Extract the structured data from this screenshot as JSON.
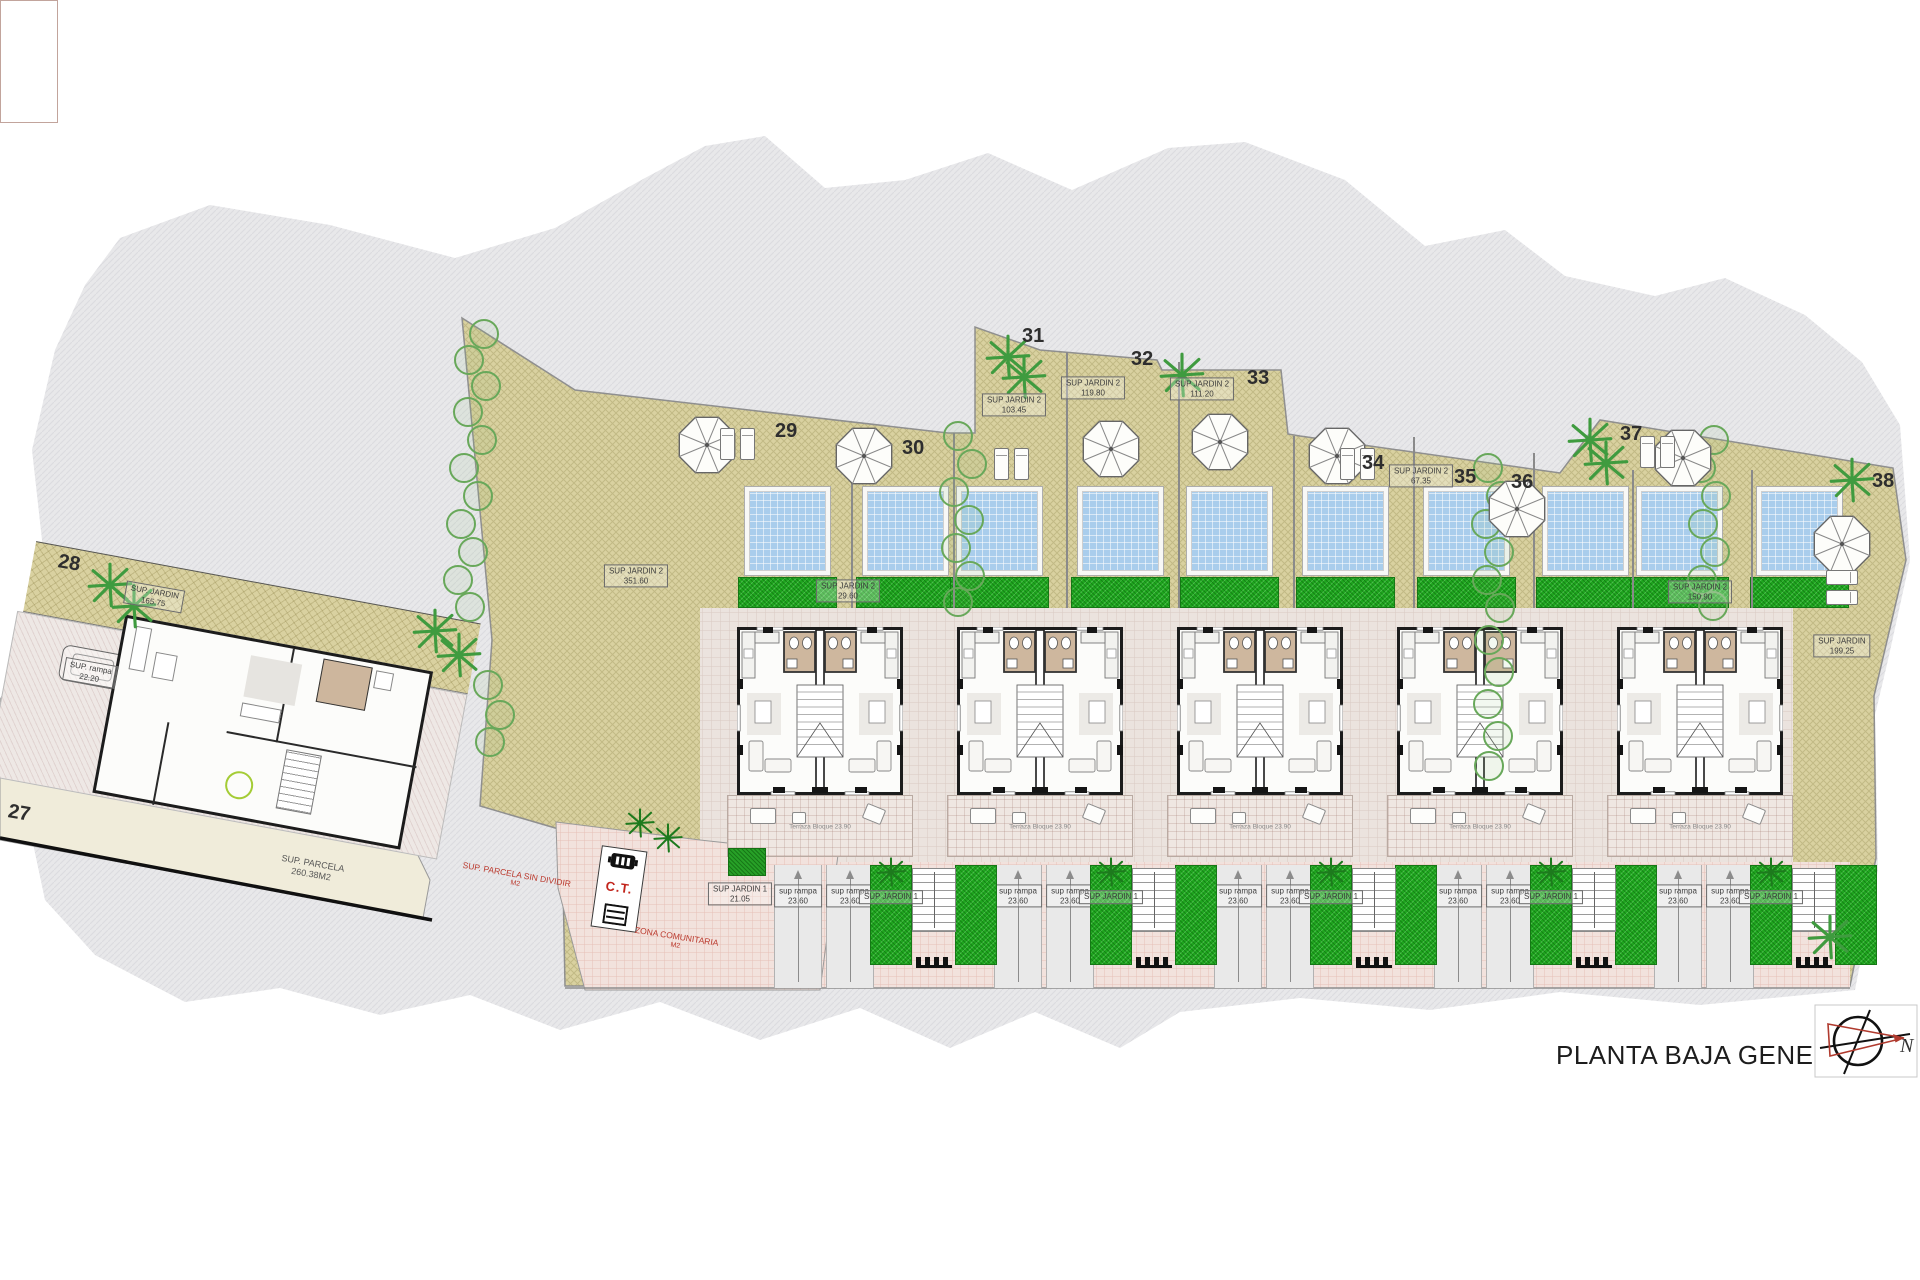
{
  "title": "PLANTA BAJA GENERAL",
  "compass": {
    "north": "N"
  },
  "transformer": {
    "label": "C.T."
  },
  "plot_numbers": [
    {
      "n": "27",
      "x": 8,
      "y": 802,
      "r": 10
    },
    {
      "n": "28",
      "x": 58,
      "y": 552,
      "r": 10
    },
    {
      "n": "29",
      "x": 775,
      "y": 420,
      "r": 0
    },
    {
      "n": "30",
      "x": 902,
      "y": 437,
      "r": 0
    },
    {
      "n": "31",
      "x": 1022,
      "y": 325,
      "r": 0
    },
    {
      "n": "32",
      "x": 1131,
      "y": 348,
      "r": 0
    },
    {
      "n": "33",
      "x": 1247,
      "y": 367,
      "r": 0
    },
    {
      "n": "34",
      "x": 1362,
      "y": 452,
      "r": 0
    },
    {
      "n": "35",
      "x": 1454,
      "y": 466,
      "r": 0
    },
    {
      "n": "36",
      "x": 1511,
      "y": 471,
      "r": 0
    },
    {
      "n": "37",
      "x": 1620,
      "y": 423,
      "r": 0
    },
    {
      "n": "38",
      "x": 1872,
      "y": 470,
      "r": 0
    }
  ],
  "area_labels": [
    {
      "l1": "SUP. JARDIN",
      "l2": "165.75",
      "x": 154,
      "y": 597,
      "r": 10,
      "box": true
    },
    {
      "l1": "SUP. rampa",
      "l2": "22.20",
      "x": 90,
      "y": 673,
      "r": 10,
      "box": true
    },
    {
      "l1": "SUP. PARCELA",
      "l2": "260.38M2",
      "x": 312,
      "y": 869,
      "r": 10,
      "box": false
    },
    {
      "l1": "SUP JARDIN 2",
      "l2": "351.60",
      "x": 636,
      "y": 576,
      "r": 0,
      "box": true
    },
    {
      "l1": "SUP JARDIN 2",
      "l2": "29.60",
      "x": 848,
      "y": 591,
      "r": 0,
      "box": true
    },
    {
      "l1": "SUP JARDIN 2",
      "l2": "103.45",
      "x": 1014,
      "y": 405,
      "r": 0,
      "box": true
    },
    {
      "l1": "SUP JARDIN 2",
      "l2": "119.80",
      "x": 1093,
      "y": 388,
      "r": 0,
      "box": true
    },
    {
      "l1": "SUP JARDIN 2",
      "l2": "111.20",
      "x": 1202,
      "y": 389,
      "r": 0,
      "box": true
    },
    {
      "l1": "SUP JARDIN 2",
      "l2": "67.35",
      "x": 1421,
      "y": 476,
      "r": 0,
      "box": true
    },
    {
      "l1": "SUP JARDIN 2",
      "l2": "150.90",
      "x": 1700,
      "y": 592,
      "r": 0,
      "box": true
    },
    {
      "l1": "SUP JARDIN",
      "l2": "199.25",
      "x": 1842,
      "y": 646,
      "r": 0,
      "box": true
    },
    {
      "l1": "SUP JARDIN 1",
      "l2": "21.05",
      "x": 740,
      "y": 894,
      "r": 0,
      "box": true
    }
  ],
  "hedge_labels": {
    "text": "SUP JARDIN 1",
    "xs": [
      891,
      1111,
      1331,
      1551,
      1771
    ],
    "y": 897
  },
  "ramp_label": {
    "l1": "sup rampa",
    "l2": "23.60"
  },
  "terrace_dim": "Terraza Bloque 23.90",
  "red_notes": [
    {
      "l1": "SUP. PARCELA SIN DIVIDIR",
      "l2": "M2",
      "x": 516,
      "y": 879,
      "r": 10
    },
    {
      "l1": "ZONA COMUNITARIA",
      "l2": "M2",
      "x": 676,
      "y": 941,
      "r": 9
    }
  ],
  "layout": {
    "pools": [
      745,
      863,
      957,
      1078,
      1187,
      1303,
      1424,
      1543,
      1637,
      1757
    ],
    "grass": [
      738,
      856,
      950,
      1071,
      1180,
      1296,
      1417,
      1536,
      1630,
      1750
    ],
    "buildings": [
      737,
      957,
      1177,
      1397,
      1617
    ],
    "ramps": [
      774,
      826,
      994,
      1046,
      1214,
      1266,
      1434,
      1486,
      1654,
      1706
    ],
    "hedges": [
      870,
      955,
      1090,
      1175,
      1310,
      1395,
      1530,
      1615,
      1750,
      1835
    ],
    "stairs": [
      912,
      1132,
      1352,
      1572,
      1792
    ],
    "gates": [
      916,
      1136,
      1356,
      1576,
      1796
    ],
    "patio": [
      710,
      865,
      58,
      123
    ],
    "green_square": [
      728,
      848,
      38,
      28
    ],
    "fences": [
      [
        851,
        433
      ],
      [
        953,
        433
      ],
      [
        1066,
        352
      ],
      [
        1178,
        362
      ],
      [
        1293,
        436
      ],
      [
        1413,
        437
      ],
      [
        1533,
        453
      ],
      [
        1632,
        470
      ],
      [
        1751,
        470
      ]
    ],
    "tree_chains": [
      [
        [
          484,
          334
        ],
        [
          469,
          360
        ],
        [
          486,
          386
        ],
        [
          468,
          412
        ],
        [
          482,
          440
        ],
        [
          464,
          468
        ],
        [
          478,
          496
        ],
        [
          461,
          524
        ],
        [
          473,
          552
        ],
        [
          458,
          580
        ],
        [
          470,
          607
        ],
        [
          488,
          685
        ],
        [
          500,
          715
        ],
        [
          490,
          742
        ]
      ],
      [
        [
          958,
          436
        ],
        [
          972,
          464
        ],
        [
          954,
          492
        ],
        [
          969,
          520
        ],
        [
          956,
          548
        ],
        [
          970,
          576
        ],
        [
          958,
          602
        ]
      ],
      [
        [
          1488,
          468
        ],
        [
          1501,
          496
        ],
        [
          1486,
          524
        ],
        [
          1499,
          552
        ],
        [
          1487,
          580
        ],
        [
          1500,
          608
        ],
        [
          1489,
          640
        ],
        [
          1499,
          672
        ],
        [
          1488,
          704
        ],
        [
          1498,
          736
        ],
        [
          1489,
          766
        ]
      ],
      [
        [
          1714,
          440
        ],
        [
          1701,
          468
        ],
        [
          1716,
          496
        ],
        [
          1703,
          524
        ],
        [
          1715,
          552
        ],
        [
          1702,
          580
        ],
        [
          1713,
          606
        ]
      ]
    ],
    "palms": [
      [
        110,
        585
      ],
      [
        134,
        606
      ],
      [
        435,
        631
      ],
      [
        459,
        655
      ],
      [
        1008,
        357
      ],
      [
        1024,
        377
      ],
      [
        1182,
        375
      ],
      [
        1590,
        440
      ],
      [
        1606,
        463
      ],
      [
        1852,
        480
      ],
      [
        1830,
        937
      ]
    ],
    "bushes": [
      [
        640,
        823
      ],
      [
        668,
        838
      ],
      [
        891,
        872
      ],
      [
        1111,
        872
      ],
      [
        1331,
        872
      ],
      [
        1551,
        872
      ],
      [
        1771,
        872
      ]
    ],
    "umbrellas": [
      [
        707,
        445
      ],
      [
        864,
        456
      ],
      [
        1111,
        449
      ],
      [
        1220,
        442
      ],
      [
        1337,
        456
      ],
      [
        1517,
        509
      ],
      [
        1683,
        458
      ],
      [
        1842,
        544
      ]
    ],
    "loungers": [
      {
        "x": 720,
        "y": 428,
        "o": "v"
      },
      {
        "x": 994,
        "y": 448,
        "o": "v"
      },
      {
        "x": 1340,
        "y": 448,
        "o": "v"
      },
      {
        "x": 1640,
        "y": 436,
        "o": "v"
      },
      {
        "x": 1822,
        "y": 572,
        "o": "h"
      }
    ]
  },
  "colors": {
    "terrain": "#e8e8ea",
    "garden_tan": "#d9d1a0",
    "pool_blue": "#a9cdec",
    "grass_green": "#1fa51f",
    "tile": "#ebe3de",
    "patio_pink": "#f2e2dd",
    "red_note": "#bb3a2e",
    "wall": "#1c1c1c"
  }
}
